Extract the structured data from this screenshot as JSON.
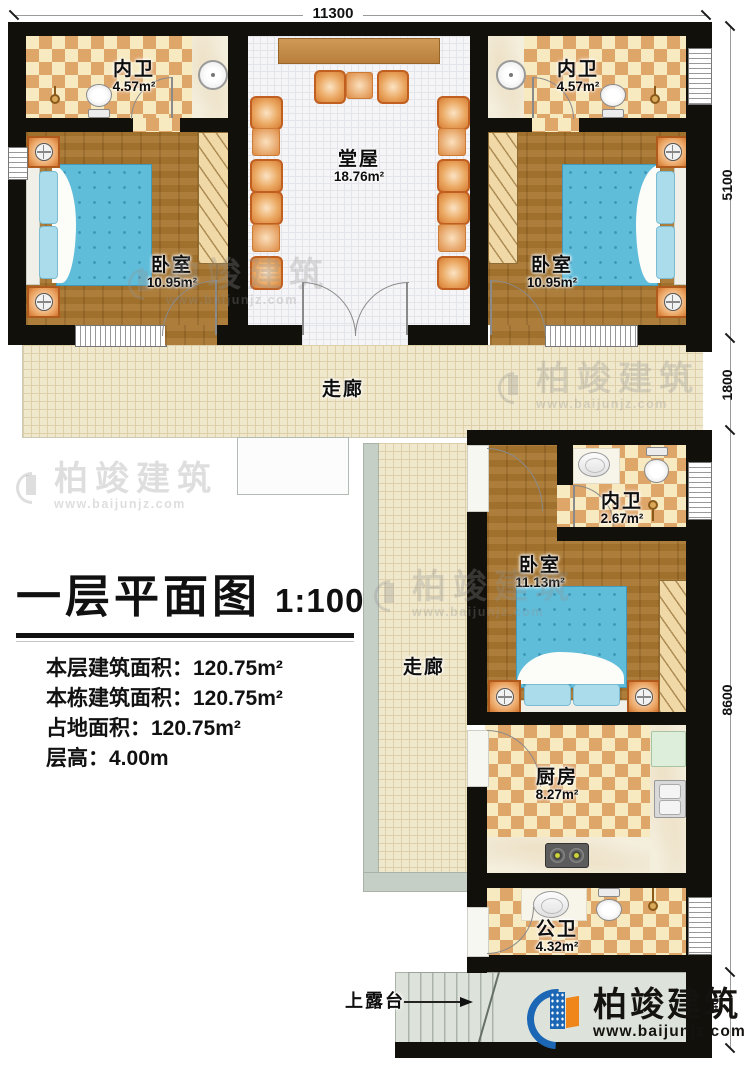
{
  "plan": {
    "title": "一层平面图",
    "scale": "1:100",
    "info_lines": [
      "本层建筑面积：120.75m²",
      "本栋建筑面积：120.75m²",
      "占地面积：120.75m²",
      "层高：4.00m"
    ]
  },
  "dimensions": {
    "top": "11300",
    "right_upper": "5100",
    "right_corridor": "1800",
    "right_lower": "8600",
    "right_bottom": "40"
  },
  "rooms": {
    "bath_top_left": {
      "name": "内卫",
      "area": "4.57m²"
    },
    "bath_top_right": {
      "name": "内卫",
      "area": "4.57m²"
    },
    "hall": {
      "name": "堂屋",
      "area": "18.76m²"
    },
    "bedroom_top_left": {
      "name": "卧室",
      "area": "10.95m²"
    },
    "bedroom_top_right": {
      "name": "卧室",
      "area": "10.95m²"
    },
    "corridor_horizontal": {
      "name": "走廊"
    },
    "corridor_vertical": {
      "name": "走廊"
    },
    "bath_middle": {
      "name": "内卫",
      "area": "2.67m²"
    },
    "bedroom_lower": {
      "name": "卧室",
      "area": "11.13m²"
    },
    "kitchen": {
      "name": "厨房",
      "area": "8.27m²"
    },
    "bath_public": {
      "name": "公卫",
      "area": "4.32m²"
    },
    "terrace": {
      "name": "上露台"
    }
  },
  "branding": {
    "name": "柏竣建筑",
    "url": "www.baijunjz.com"
  },
  "watermark": {
    "name": "柏竣建筑",
    "url": "www.baijunjz.com"
  },
  "colors": {
    "wall": "#12100b",
    "checker_dark": "#dfa66a",
    "checker_light": "#f7e9c0",
    "wood": "#a8762f",
    "bed": "#5fbdda",
    "corridor_floor": "#f0e8cc",
    "hall_floor": "#f5f5f7",
    "terrace_floor": "#dde3da",
    "logo_blue": "#1b66b5",
    "logo_orange": "#f08519"
  }
}
